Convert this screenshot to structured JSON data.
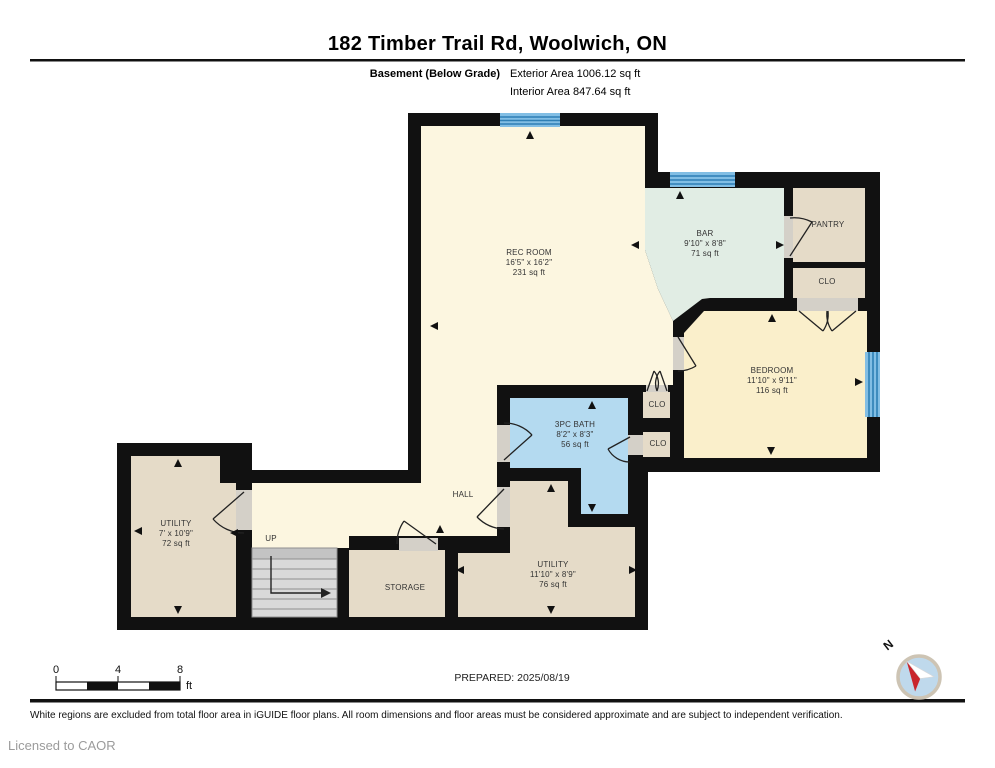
{
  "header": {
    "title": "182 Timber Trail Rd, Woolwich, ON",
    "floor_label": "Basement (Below Grade)",
    "exterior_area": "Exterior Area 1006.12 sq ft",
    "interior_area": "Interior Area 847.64 sq ft"
  },
  "rooms": [
    {
      "id": "rec-room",
      "name": "REC ROOM",
      "dims": "16'5\" x 16'2\"",
      "area": "231 sq ft"
    },
    {
      "id": "bar",
      "name": "BAR",
      "dims": "9'10\" x 8'8\"",
      "area": "71 sq ft"
    },
    {
      "id": "pantry",
      "name": "PANTRY"
    },
    {
      "id": "clo-upper",
      "name": "CLO"
    },
    {
      "id": "bedroom",
      "name": "BEDROOM",
      "dims": "11'10\" x 9'11\"",
      "area": "116 sq ft"
    },
    {
      "id": "bath",
      "name": "3PC BATH",
      "dims": "8'2\" x 8'3\"",
      "area": "56 sq ft"
    },
    {
      "id": "clo-1",
      "name": "CLO"
    },
    {
      "id": "clo-2",
      "name": "CLO"
    },
    {
      "id": "utility-left",
      "name": "UTILITY",
      "dims": "7' x 10'9\"",
      "area": "72 sq ft"
    },
    {
      "id": "hall",
      "name": "HALL"
    },
    {
      "id": "up",
      "name": "UP"
    },
    {
      "id": "storage",
      "name": "STORAGE"
    },
    {
      "id": "utility-lower",
      "name": "UTILITY",
      "dims": "11'10\" x 8'9\"",
      "area": "76 sq ft"
    }
  ],
  "scale_bar": {
    "tick_labels": [
      "0",
      "4",
      "8"
    ],
    "unit": "ft"
  },
  "compass": {
    "label": "N"
  },
  "footer": {
    "prepared": "PREPARED: 2025/08/19",
    "disclaimer": "White regions are excluded from total floor area in iGUIDE floor plans. All room dimensions and floor areas must be considered approximate and are subject to independent verification.",
    "license": "Licensed to CAOR"
  },
  "colors": {
    "wall": "#111111",
    "room_cream": "#FCF6E0",
    "room_cream_dark": "#FAEFCB",
    "room_tan": "#E5DBC8",
    "room_green": "#E1EDE4",
    "room_blue": "#B4DAF0",
    "window_fill": "#82BEE4",
    "window_stripe": "#2E7FB5",
    "stairs_gray": "#D9D9D9",
    "opening_gray": "#D4D0C8",
    "compass_red": "#C9252C",
    "compass_face": "#BFD9EC"
  }
}
